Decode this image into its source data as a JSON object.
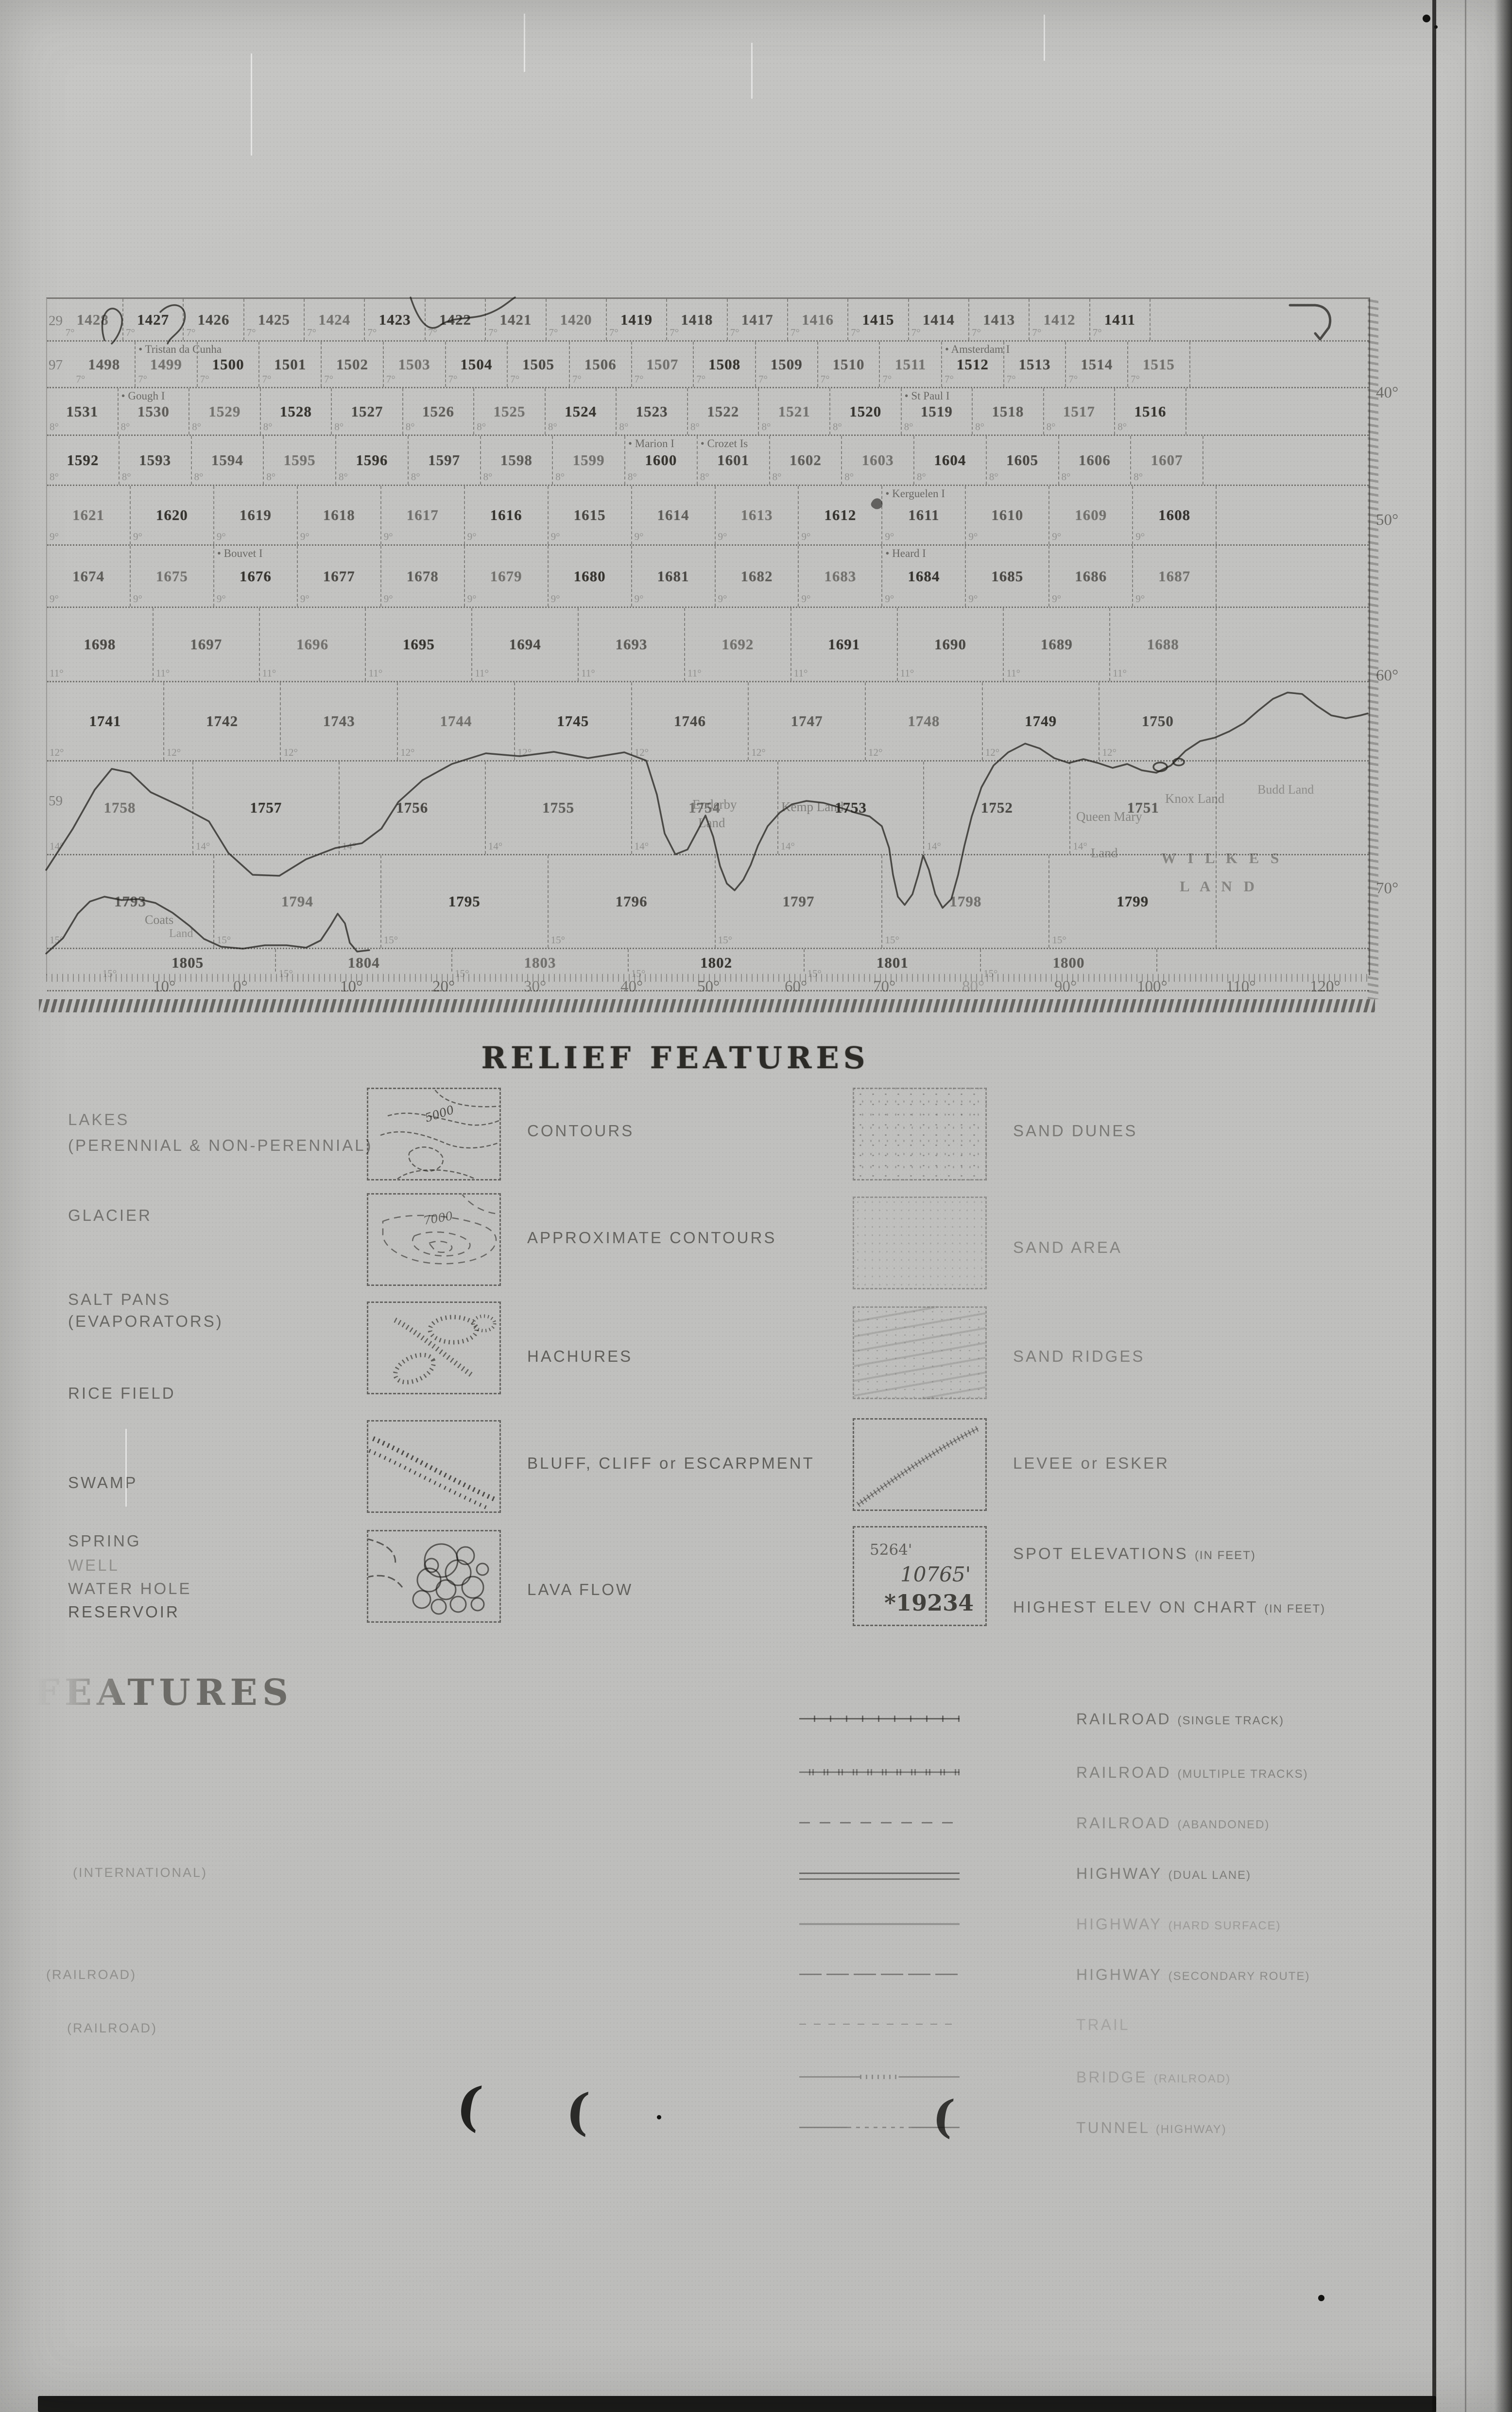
{
  "grid": {
    "left_partials": {
      "0": "29",
      "1": "97",
      "8": "59"
    },
    "rows": [
      {
        "deg": "7°",
        "cells": [
          "1428",
          "1427",
          "1426",
          "1425",
          "1424",
          "1423",
          "1422",
          "1421",
          "1420",
          "1419",
          "1418",
          "1417",
          "1416",
          "1415",
          "1414",
          "1413",
          "1412",
          "1411"
        ]
      },
      {
        "deg": "7°",
        "cells": [
          "1498",
          "1499",
          "1500",
          "1501",
          "1502",
          "1503",
          "1504",
          "1505",
          "1506",
          "1507",
          "1508",
          "1509",
          "1510",
          "1511",
          "1512",
          "1513",
          "1514",
          "1515"
        ],
        "notes": {
          "1": {
            "text": "Tristan da Cunha",
            "dot": true
          },
          "14": {
            "text": "Amsterdam I",
            "dot": true
          }
        }
      },
      {
        "deg": "8°",
        "cells": [
          "1531",
          "1530",
          "1529",
          "1528",
          "1527",
          "1526",
          "1525",
          "1524",
          "1523",
          "1522",
          "1521",
          "1520",
          "1519",
          "1518",
          "1517",
          "1516"
        ],
        "notes": {
          "1": {
            "text": "Gough I",
            "dot": true
          },
          "12": {
            "text": "St Paul I",
            "dot": true
          }
        }
      },
      {
        "deg": "8°",
        "cells": [
          "1592",
          "1593",
          "1594",
          "1595",
          "1596",
          "1597",
          "1598",
          "1599",
          "1600",
          "1601",
          "1602",
          "1603",
          "1604",
          "1605",
          "1606",
          "1607"
        ],
        "notes": {
          "8": {
            "text": "Marion I",
            "dot": true
          },
          "9": {
            "text": "Crozet Is",
            "dot": true
          }
        }
      },
      {
        "deg": "9°",
        "cells": [
          "1621",
          "1620",
          "1619",
          "1618",
          "1617",
          "1616",
          "1615",
          "1614",
          "1613",
          "1612",
          "1611",
          "1610",
          "1609",
          "1608"
        ],
        "notes": {
          "10": {
            "text": "Kerguelen I",
            "dot": true
          }
        }
      },
      {
        "deg": "9°",
        "cells": [
          "1674",
          "1675",
          "1676",
          "1677",
          "1678",
          "1679",
          "1680",
          "1681",
          "1682",
          "1683",
          "1684",
          "1685",
          "1686",
          "1687"
        ],
        "notes": {
          "2": {
            "text": "Bouvet I",
            "dot": true
          },
          "10": {
            "text": "Heard I",
            "dot": true
          }
        }
      },
      {
        "deg": "11°",
        "cells": [
          "1698",
          "1697",
          "1696",
          "1695",
          "1694",
          "1693",
          "1692",
          "1691",
          "1690",
          "1689",
          "1688"
        ]
      },
      {
        "deg": "12°",
        "cells": [
          "1741",
          "1742",
          "1743",
          "1744",
          "1745",
          "1746",
          "1747",
          "1748",
          "1749",
          "1750"
        ]
      },
      {
        "deg": "14°",
        "cells": [
          "1758",
          "1757",
          "1756",
          "1755",
          "1754",
          "1753",
          "1752",
          "1751"
        ]
      },
      {
        "deg": "15°",
        "cells": [
          "1793",
          "1794",
          "1795",
          "1796",
          "1797",
          "1798",
          "1799"
        ]
      },
      {
        "deg": "15°",
        "cells": [
          "1805",
          "1804",
          "1803",
          "1802",
          "1801",
          "1800"
        ]
      }
    ],
    "lat_labels": [
      "40°",
      "50°",
      "60°",
      "70°"
    ],
    "axis_labels": [
      "10°",
      "0°",
      "10°",
      "20°",
      "30°",
      "40°",
      "50°",
      "60°",
      "70°",
      "80°",
      "90°",
      "100°",
      "110°",
      "120°"
    ],
    "land_labels": [
      "Enderby",
      "Land",
      "Kemp Land",
      "Queen Mary",
      "Land",
      "Knox Land",
      "Budd Land",
      "W I L K E S",
      "L A N D",
      "Coats",
      "Land"
    ]
  },
  "relief": {
    "title": "RELIEF FEATURES",
    "left_labels": [
      {
        "text": "LAKES",
        "sub": "(PERENNIAL & NON-PERENNIAL)"
      },
      {
        "text": "GLACIER"
      },
      {
        "text": "SALT PANS",
        "sub": "(EVAPORATORS)"
      },
      {
        "text": "RICE FIELD"
      },
      {
        "text": "SWAMP"
      },
      {
        "text": "SPRING"
      },
      {
        "text": "WELL"
      },
      {
        "text": "WATER HOLE"
      },
      {
        "text": "RESERVOIR"
      }
    ],
    "mid_rows": [
      {
        "label": "CONTOURS",
        "value": "5000"
      },
      {
        "label": "APPROXIMATE CONTOURS",
        "value": "7000"
      },
      {
        "label": "HACHURES"
      },
      {
        "label": "BLUFF, CLIFF or ESCARPMENT"
      },
      {
        "label": "LAVA FLOW"
      }
    ],
    "right_rows": [
      {
        "label": "SAND DUNES"
      },
      {
        "label": "SAND AREA"
      },
      {
        "label": "SAND  RIDGES"
      },
      {
        "label": "LEVEE or ESKER"
      },
      {
        "label": "SPOT ELEVATIONS",
        "label_sub": "(IN FEET)",
        "label2": "HIGHEST ELEV ON CHART",
        "label2_sub": "(IN FEET)",
        "values": [
          "5264'",
          "10765'",
          "*19234"
        ]
      }
    ]
  },
  "cultural": {
    "heading": "FEATURES",
    "left_labels": [
      "(INTERNATIONAL)",
      "(RAILROAD)",
      "(RAILROAD)"
    ],
    "rows": [
      {
        "label": "RAILROAD",
        "sub": "(SINGLE TRACK)"
      },
      {
        "label": "RAILROAD",
        "sub": "(MULTIPLE TRACKS)"
      },
      {
        "label": "RAILROAD",
        "sub": "(ABANDONED)"
      },
      {
        "label": "HIGHWAY",
        "sub": "(DUAL LANE)"
      },
      {
        "label": "HIGHWAY",
        "sub": "(HARD SURFACE)"
      },
      {
        "label": "HIGHWAY",
        "sub": "(SECONDARY ROUTE)"
      },
      {
        "label": "TRAIL",
        "sub": ""
      },
      {
        "label": "BRIDGE",
        "sub": "(RAILROAD)"
      },
      {
        "label": "TUNNEL",
        "sub": "(HIGHWAY)"
      }
    ]
  },
  "artifacts": {
    "paren_marks": [
      "(",
      "(",
      "("
    ]
  }
}
